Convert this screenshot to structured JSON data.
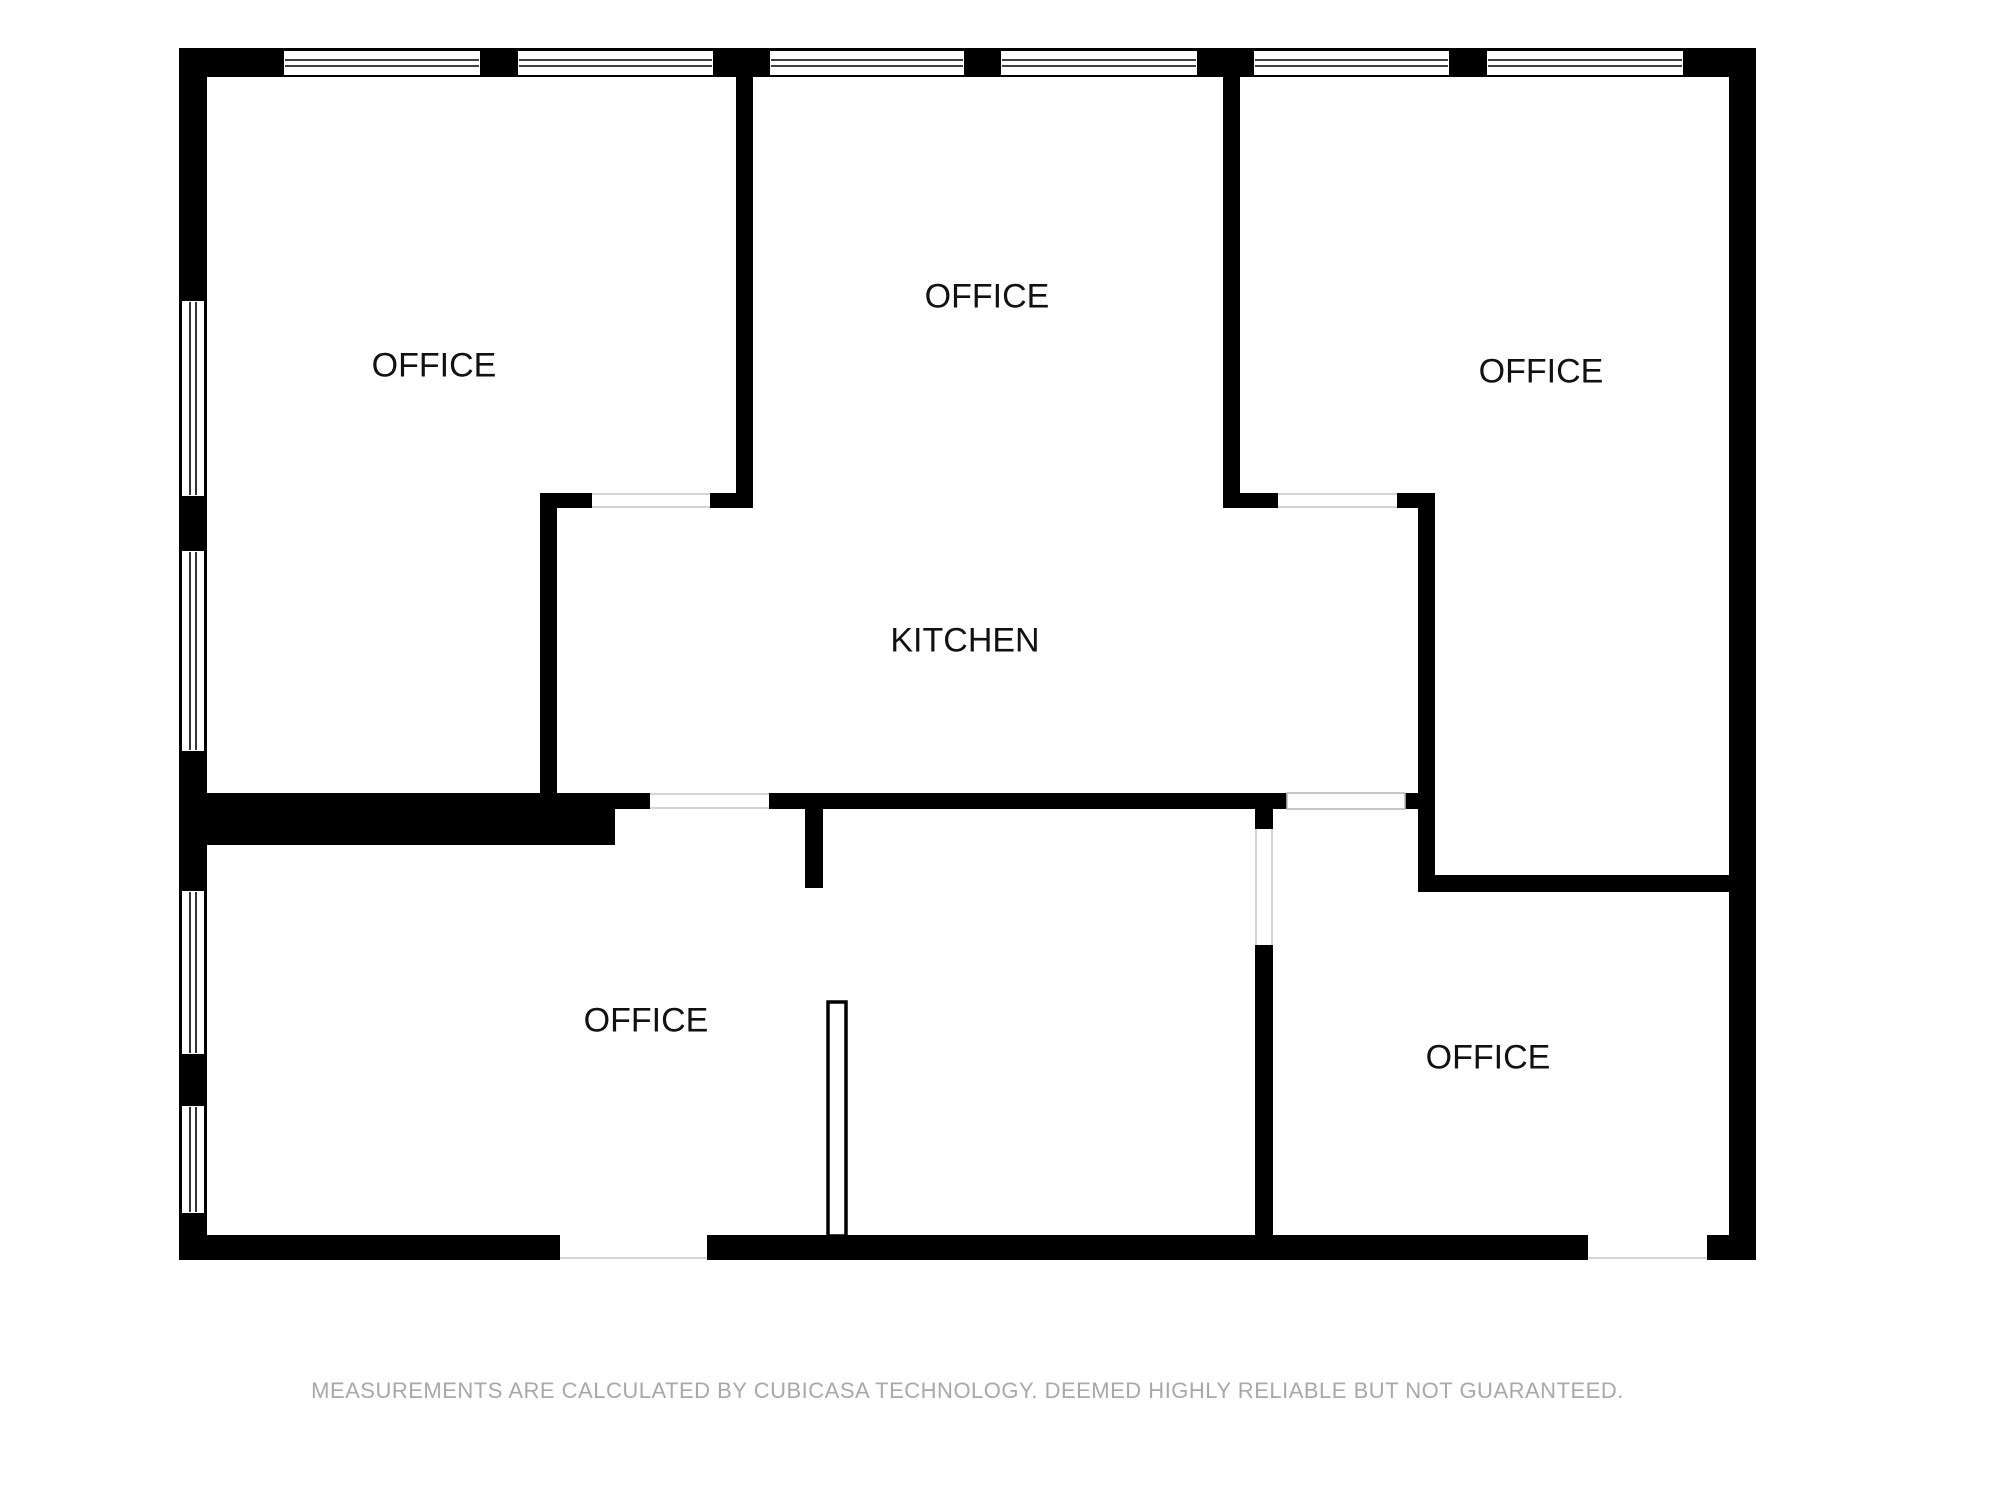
{
  "plan": {
    "type": "floorplan",
    "rooms": [
      {
        "id": "office-top-left",
        "label": "OFFICE"
      },
      {
        "id": "office-top-middle",
        "label": "OFFICE"
      },
      {
        "id": "office-top-right",
        "label": "OFFICE"
      },
      {
        "id": "kitchen",
        "label": "KITCHEN"
      },
      {
        "id": "office-bottom-left",
        "label": "OFFICE"
      },
      {
        "id": "office-bottom-right",
        "label": "OFFICE"
      }
    ],
    "disclaimer": "MEASUREMENTS ARE CALCULATED BY CUBICASA TECHNOLOGY. DEEMED HIGHLY RELIABLE BUT NOT GUARANTEED.",
    "colors": {
      "wall": "#000000",
      "label": "#111111",
      "opening_outline": "#c6c6c6",
      "disclaimer_text": "#a8a8a8",
      "background": "#ffffff"
    }
  }
}
